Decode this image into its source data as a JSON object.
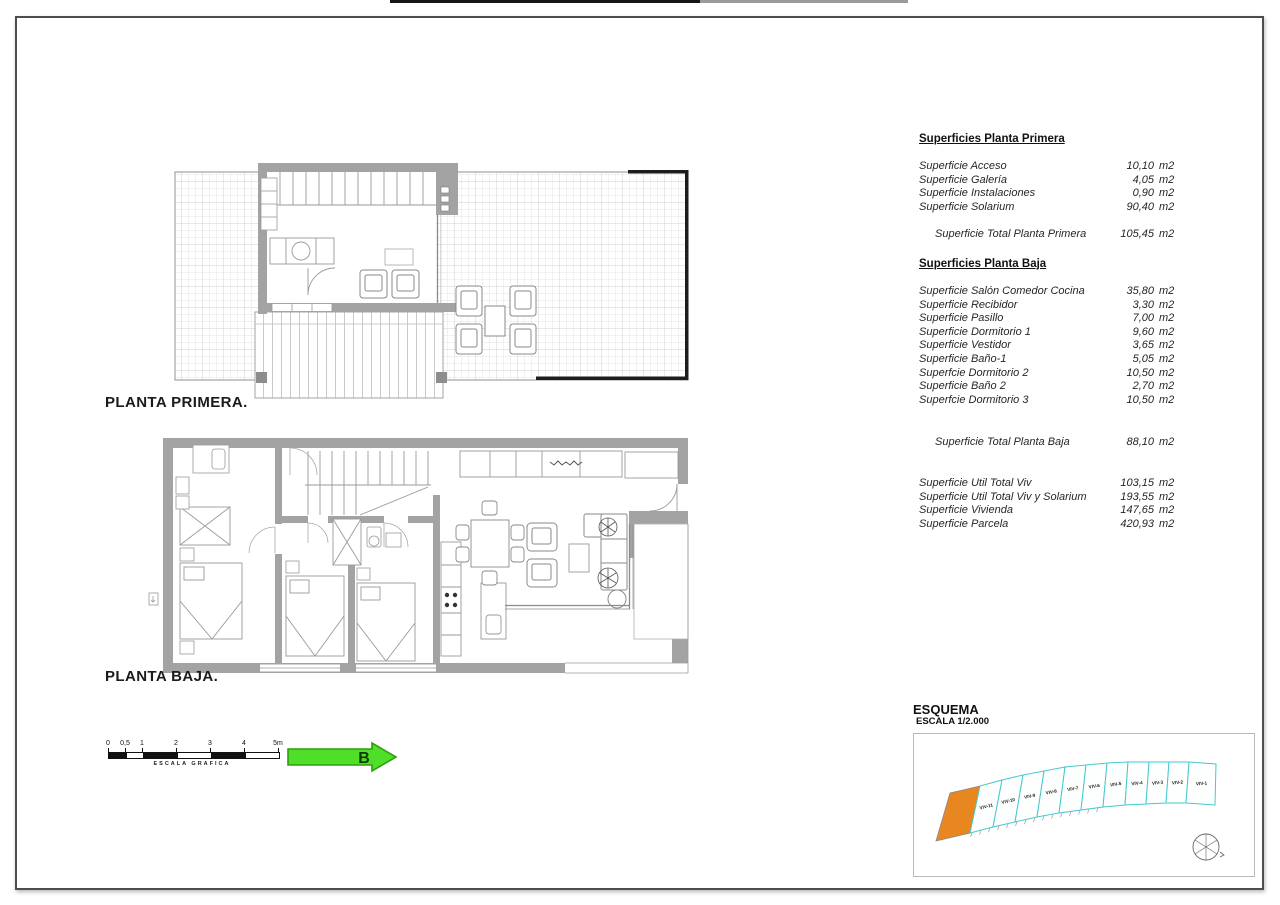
{
  "plans": {
    "first_floor_label": "PLANTA PRIMERA.",
    "ground_floor_label": "PLANTA BAJA."
  },
  "tables": {
    "planta_primera": {
      "title": "Superficies Planta Primera",
      "rows": [
        {
          "label": "Superficie Acceso",
          "value": "10,10",
          "unit": "m2"
        },
        {
          "label": "Superficie Galería",
          "value": "4,05",
          "unit": "m2"
        },
        {
          "label": "Superficie Instalaciones",
          "value": "0,90",
          "unit": "m2"
        },
        {
          "label": "Superficie Solarium",
          "value": "90,40",
          "unit": "m2"
        }
      ],
      "total": {
        "label": "Superficie Total Planta Primera",
        "value": "105,45",
        "unit": "m2"
      }
    },
    "planta_baja": {
      "title": "Superficies Planta Baja",
      "rows": [
        {
          "label": "Superficie Salón Comedor Cocina",
          "value": "35,80",
          "unit": "m2"
        },
        {
          "label": "Superficie Recibidor",
          "value": "3,30",
          "unit": "m2"
        },
        {
          "label": "Superficie Pasillo",
          "value": "7,00",
          "unit": "m2"
        },
        {
          "label": "Superficie Dormitorio 1",
          "value": "9,60",
          "unit": "m2"
        },
        {
          "label": "Superficie Vestidor",
          "value": "3,65",
          "unit": "m2"
        },
        {
          "label": "Superficie Baño-1",
          "value": "5,05",
          "unit": "m2"
        },
        {
          "label": "Superfcie Dormitorio 2",
          "value": "10,50",
          "unit": "m2"
        },
        {
          "label": "Superficie Baño 2",
          "value": "2,70",
          "unit": "m2"
        },
        {
          "label": "Superfcie Dormitorio 3",
          "value": "10,50",
          "unit": "m2"
        }
      ],
      "total": {
        "label": "Superficie Total Planta Baja",
        "value": "88,10",
        "unit": "m2"
      }
    },
    "summary": {
      "rows": [
        {
          "label": "Superficie Util Total Viv",
          "value": "103,15",
          "unit": "m2"
        },
        {
          "label": "Superficie Util Total Viv y Solarium",
          "value": "193,55",
          "unit": "m2"
        },
        {
          "label": "Superficie Vivienda",
          "value": "147,65",
          "unit": "m2"
        },
        {
          "label": "Superficie Parcela",
          "value": "420,93",
          "unit": "m2"
        }
      ]
    }
  },
  "scale_bar": {
    "ticks": [
      "0",
      "0,5",
      "1",
      "2",
      "3",
      "4",
      "5m"
    ],
    "label": "ESCALA GRAFICA"
  },
  "arrow": {
    "label": "B",
    "fill": "#4fdf28",
    "border": "#2f9e0e"
  },
  "esquema": {
    "title": "ESQUEMA",
    "subtitle": "ESCALA 1/2.000",
    "plots": [
      "VIV-11",
      "VIV-10",
      "VIV-9",
      "VIV-8",
      "VIV-7",
      "VIV-6",
      "VIV-5",
      "VIV-4",
      "VIV-3",
      "VIV-2",
      "VIV-1"
    ],
    "highlight_color": "#e8871f",
    "outline_color": "#45c8ce"
  }
}
